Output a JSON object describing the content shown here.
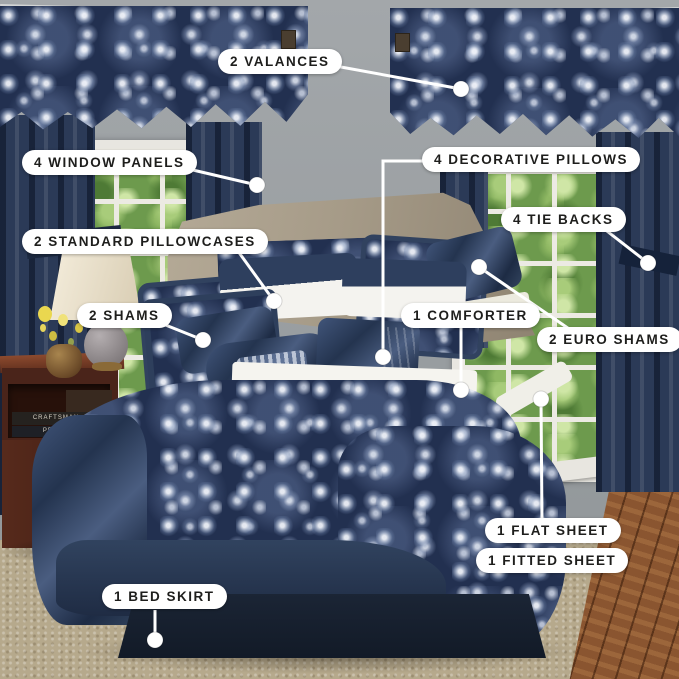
{
  "callouts": [
    {
      "id": "valances",
      "label": "2 VALANCES"
    },
    {
      "id": "window-panels",
      "label": "4 WINDOW PANELS"
    },
    {
      "id": "standard-pillowcases",
      "label": "2 STANDARD PILLOWCASES"
    },
    {
      "id": "decorative-pillows",
      "label": "4 DECORATIVE PILLOWS"
    },
    {
      "id": "tie-backs",
      "label": "4 TIE BACKS"
    },
    {
      "id": "shams",
      "label": "2 SHAMS"
    },
    {
      "id": "comforter",
      "label": "1 COMFORTER"
    },
    {
      "id": "euro-shams",
      "label": "2 EURO SHAMS"
    },
    {
      "id": "flat-sheet",
      "label": "1 FLAT SHEET"
    },
    {
      "id": "fitted-sheet",
      "label": "1 FITTED SHEET"
    },
    {
      "id": "bed-skirt",
      "label": "1 BED SKIRT"
    }
  ],
  "books": {
    "spine1": "CRAFTSMAN",
    "spine2": "PREPPY"
  },
  "colors": {
    "navy": "#223050",
    "satin_navy": "#33455f",
    "silver_paisley": "#cdd5e4",
    "wall": "#9da2a5",
    "headboard": "#a69b88",
    "carpet": "#b6a98c",
    "wood_floor": "#8a5530",
    "callout_bg": "#ffffff",
    "callout_text": "#1e1e1c"
  }
}
